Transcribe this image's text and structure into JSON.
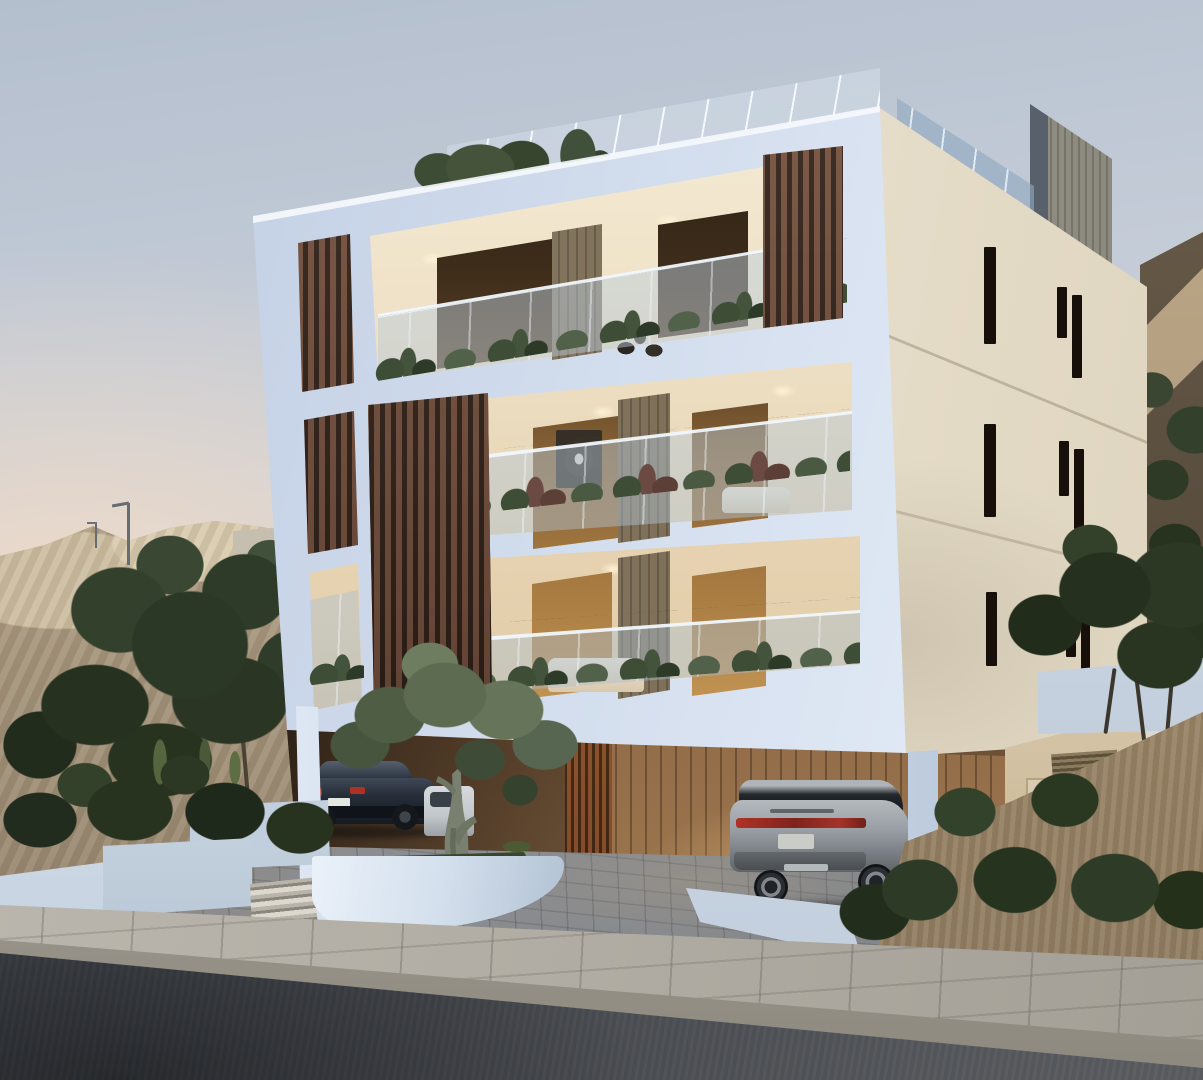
{
  "scene": {
    "domain": "architectural-exterior-render",
    "time_of_day": "dusk",
    "summary": "Photorealistic dusk rendering of a modern three-storey apartment block with white/blue-tinted frames, cream side facade with narrow slit windows, dark rosewood vertical louver screens, glass balconies planted with greenery, warm-lit interiors, rooftop terrace with frameless glass railing and grey concrete stair box, ground-level carport with two cars, olive trees, white sculptural planter walls, paved driveway, concrete sidewalk and dark asphalt road sloping across the foreground, sandy excavated hill with street lamps behind.",
    "visible_text": [],
    "building": {
      "storeys": 3,
      "front_floors": [
        "top balcony with louver screen right",
        "middle balcony with full-height louver screen left",
        "lower balcony with louver screen left"
      ],
      "side_slit_windows": 9,
      "rooftop": [
        "glass railing",
        "concrete stair box",
        "roof shrubs"
      ],
      "carport": [
        "rust louver screen",
        "timber plank wall",
        "cream wall with vent and door",
        "two white pillars"
      ]
    },
    "vehicles": [
      {
        "type": "sedan",
        "color": "#262d38",
        "location": "carport left",
        "details": [
          "red taillights",
          "white license plate"
        ]
      },
      {
        "type": "partial-car",
        "color": "#cdd1d4",
        "location": "behind olive tree"
      },
      {
        "type": "suv",
        "color": "#9aa0a5",
        "location": "driveway under building",
        "details": [
          "red taillight band",
          "tailgate lettering strip",
          "alloy wheels"
        ]
      }
    ],
    "landscape": {
      "left": [
        "sandy hill",
        "concrete retaining wall",
        "2 street lamps",
        "dark olive trees",
        "planted white walls",
        "concrete steps"
      ],
      "center": [
        "large olive tree in curved white planter",
        "grass sliver"
      ],
      "right": [
        "white garden wall",
        "olive trees with thin trunks",
        "sandy bed with shrubs",
        "dark scrub hillside"
      ]
    },
    "street": {
      "elements": [
        "paver driveway",
        "concrete paver sidewalk",
        "curb",
        "asphalt road"
      ],
      "road_markings": []
    },
    "palette": {
      "sky_top": "#b4bfce",
      "sky_horizon_warm": "#eedccb",
      "hill_sand": "#c0ae92",
      "hill_shadow": "#8e7d66",
      "tree_dark": "#2c3826",
      "olive_canopy": "#66755a",
      "facade_front": "#d5e0ef",
      "facade_side": "#eae2d0",
      "slit_window": "#17100a",
      "louver_wood": "#6e4837",
      "interior_warm": "#efe2c8",
      "window_glow": "#e0b269",
      "window_frame": "#281d12",
      "balustrade_glass": "#a9becf",
      "roof_box": "#8f8e85",
      "carport_rust": "#a05a30",
      "carport_wood": "#8a6644",
      "driveway": "#8b8d91",
      "planter_white": "#dfe9f3",
      "shrub_dark": "#27331f",
      "sidewalk": "#b0aca3",
      "road": "#45484d",
      "sedan_body": "#262d38",
      "taillight_red": "#b03024",
      "suv_body": "#9aa0a5",
      "lamp_pole": "#666c73"
    }
  }
}
